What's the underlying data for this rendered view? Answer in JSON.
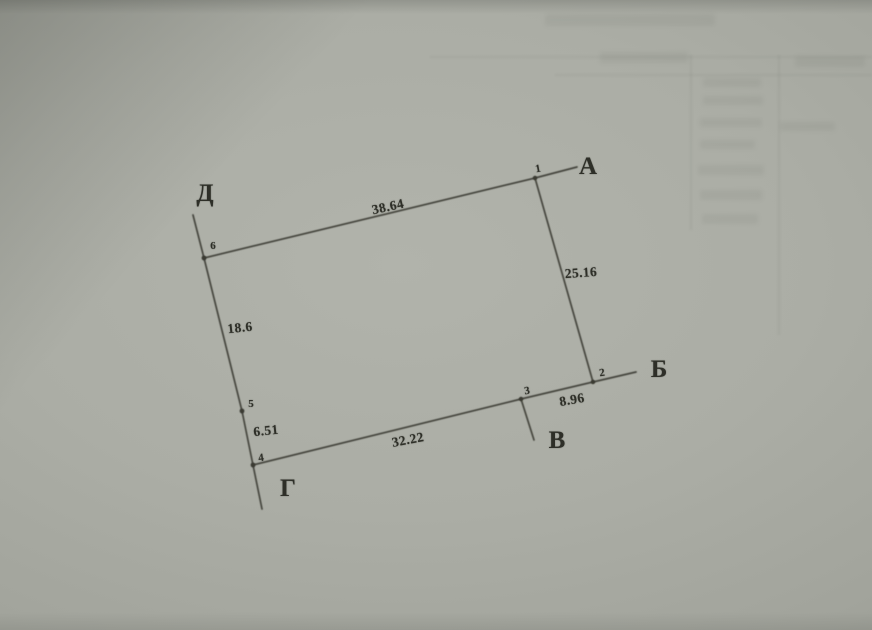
{
  "photo": {
    "paper_color": "#abada5",
    "line_color": "#44453d",
    "ink_color": "#2e2f28",
    "description": "scanned/photographed land-plot boundary sketch on grey paper"
  },
  "diagram": {
    "kind": "land-plot-boundary-sketch",
    "vertices": [
      {
        "id": "1"
      },
      {
        "id": "2"
      },
      {
        "id": "3"
      },
      {
        "id": "4"
      },
      {
        "id": "5"
      },
      {
        "id": "6"
      }
    ],
    "sides": [
      {
        "from": "6",
        "to": "1",
        "length": "38.64"
      },
      {
        "from": "1",
        "to": "2",
        "length": "25.16"
      },
      {
        "from": "2",
        "to": "3",
        "length": "8.96"
      },
      {
        "from": "3",
        "to": "4",
        "length": "32.22"
      },
      {
        "from": "4",
        "to": "5",
        "length": "6.51"
      },
      {
        "from": "5",
        "to": "6",
        "length": "18.6"
      }
    ],
    "direction_labels": [
      {
        "letter": "А",
        "at_vertex": "1"
      },
      {
        "letter": "Б",
        "at_vertex": "2"
      },
      {
        "letter": "В",
        "at_vertex": "3"
      },
      {
        "letter": "Г",
        "at_vertex": "4"
      },
      {
        "letter": "Д",
        "at_vertex": "6"
      }
    ]
  }
}
